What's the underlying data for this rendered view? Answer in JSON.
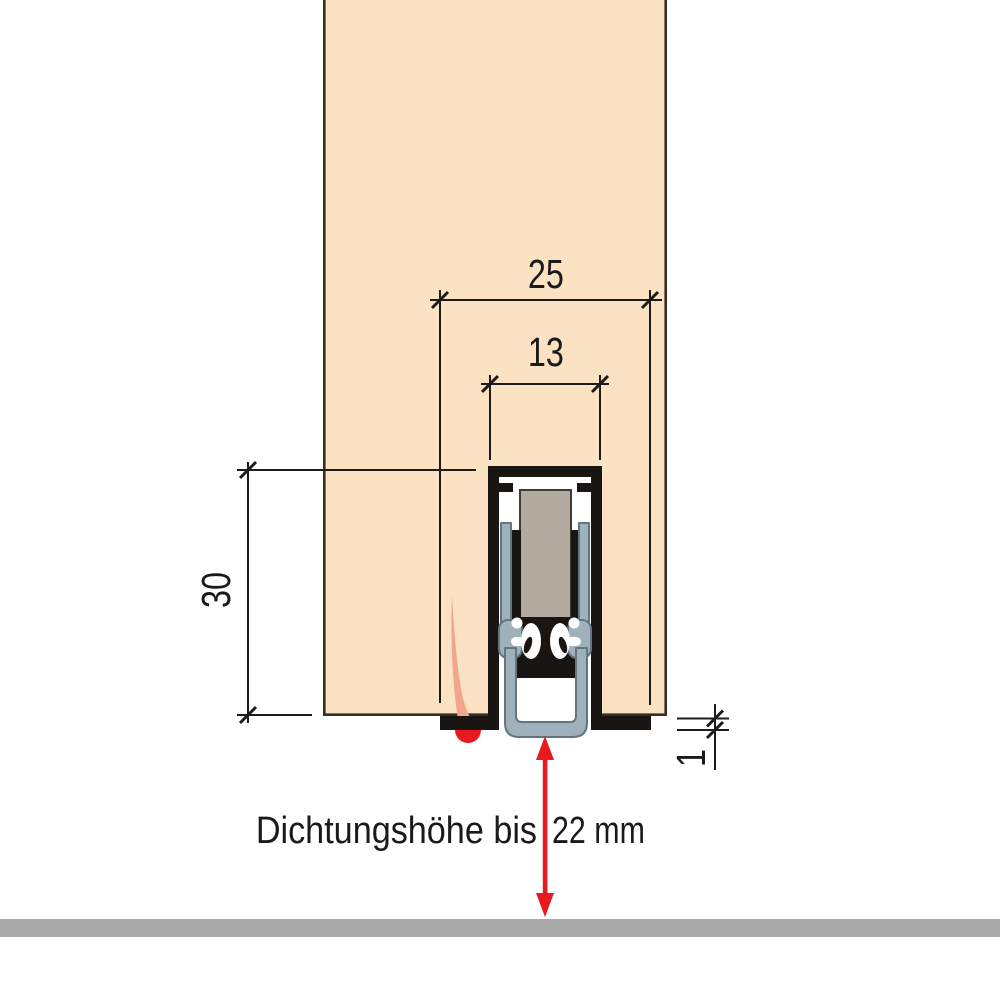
{
  "diagram": {
    "type": "technical-cross-section",
    "subject": "door bottom drop-down seal installed in groove of door leaf",
    "dimensions": {
      "groove_outer_width": "25",
      "groove_inner_width": "13",
      "groove_depth": "30",
      "bottom_projection": "1"
    },
    "annotation": {
      "seal_height_label": "Dichtungshöhe bis",
      "seal_height_value": "22 mm"
    },
    "colors": {
      "door_panel": "#fbe2c2",
      "door_edge": "#352e27",
      "housing_black": "#181512",
      "carrier_slate": "#9fb2bc",
      "carrier_outline": "#64757f",
      "block_gray": "#b3aaa0",
      "block_outline": "#413c35",
      "line_black": "#1c1c1c",
      "arrow_red": "#e8191f",
      "drip_salmon": "#f3a68e",
      "floor_gray": "#a9a9a9",
      "white": "#ffffff"
    }
  }
}
